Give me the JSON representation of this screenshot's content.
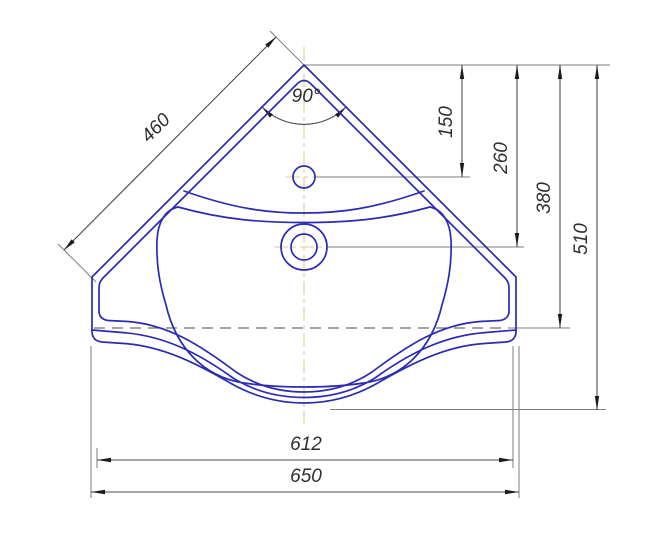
{
  "drawing": {
    "title": "Corner washbasin — dimensioned top view",
    "dimensions": {
      "edge_length": "460",
      "corner_angle": "90°",
      "faucet_center_offset": "150",
      "drain_center_offset": "260",
      "waterline_offset": "380",
      "overall_depth": "510",
      "inner_width": "612",
      "overall_width": "650"
    },
    "colors": {
      "outline_blue": "#2b2bb4",
      "dimension_gray": "#4a4a4a",
      "extension_gray": "#7d7d7d",
      "arrow_black": "#1c1c1c",
      "centerline_tan": "#dcc998",
      "text": "#2e2e2e",
      "background": "#ffffff"
    }
  }
}
